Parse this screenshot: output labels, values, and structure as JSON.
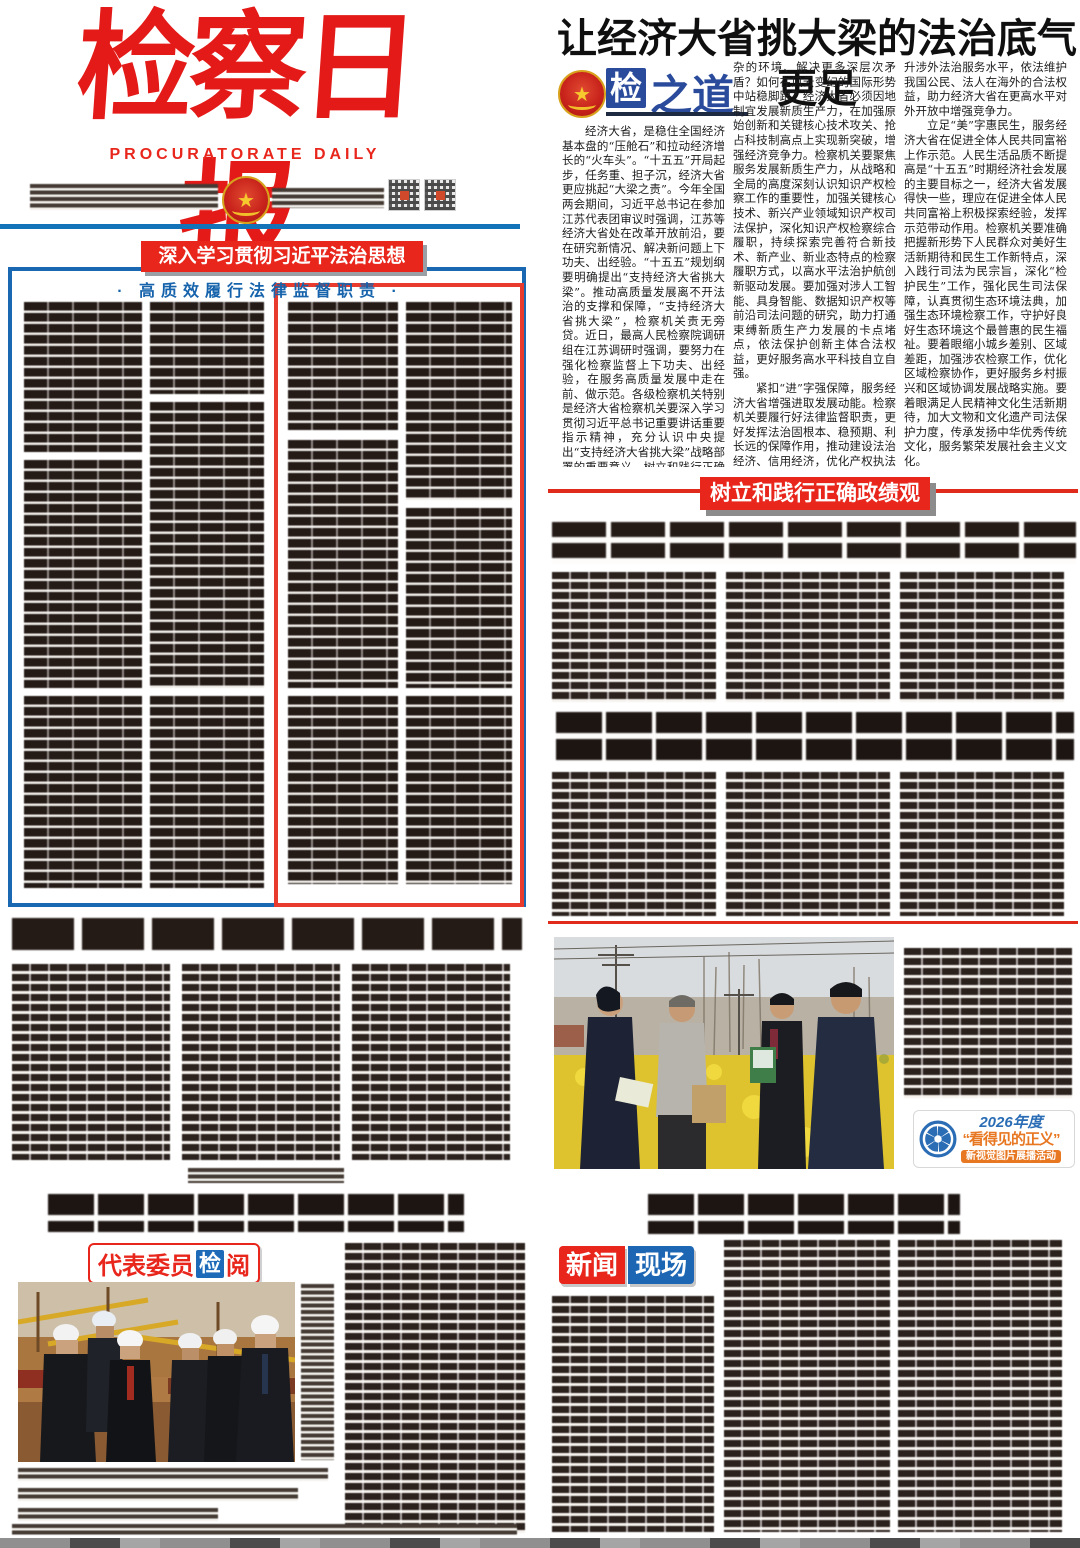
{
  "masthead": {
    "title": "检察日报",
    "subtitle": "PROCURATORATE DAILY"
  },
  "left_section": {
    "banner_line1": "深入学习贯彻习近平法治思想",
    "banner_line2": "· 高质效履行法律监督职责 ·",
    "rep_badge": {
      "part1": "代表委员",
      "part2": "检",
      "part3": "阅"
    }
  },
  "right_section": {
    "headline": "让经济大省挑大梁的法治底气更足",
    "column_badge": {
      "jian": "检",
      "zhidao": "之道"
    },
    "columns": [
      {
        "paras": [
          "经济大省，是稳住全国经济基本盘的“压舱石”和拉动经济增长的“火车头”。“十五五”开局起步，任务重、担子沉，经济大省更应挑起“大梁之责”。今年全国两会期间，习近平总书记在参加江苏代表团审议时强调，江苏等经济大省处在改革开放前沿，要在研究新情况、解决新问题上下功夫、出经验。“十五五”规划纲要明确提出“支持经济大省挑大梁”。推动高质量发展离不开法治的支撑和保障，“支持经济大省挑大梁”，检察机关责无旁贷。近日，最高人民检察院调研组在江苏调研时强调，要努力在强化检察监督上下功夫、出经验，在服务高质量发展中走在前、做示范。各级检察机关特别是经济大省检察机关要深入学习贯彻习近平总书记重要讲话重要指示精神，充分认识中央提出“支持经济大省挑大梁”战略部署的重要意义，树立和践行正确政绩观，坚持围绕中心、服务大局，锚定“稳”字强保障，紧扣“进”字护发展，立足“美”字惠民生，自觉扛起服务高质量发展的政治责任、检察责任，为经济大省挑大梁，谋新局注入更多的法治底气。"
        ]
      },
      {
        "paras": [
          "杂的环境、解决更多深层次矛盾？如何在风云变幻的国际形势中站稳脚跟？经济大省必须因地制宜发展新质生产力，在加强原始创新和关键核心技术攻关、抢占科技制高点上实现新突破，增强经济竞争力。检察机关要聚焦服务发展新质生产力，从战略和全局的高度深刻认识知识产权检察工作的重要性，加强关键核心技术、新兴产业领域知识产权司法保护，深化知识产权检察综合履职，持续探索完善符合新技术、新产业、新业态特点的检察履职方式，以高水平法治护航创新驱动发展。要加强对涉人工智能、具身智能、数据知识产权等前沿司法问题的研究，助力打通束缚新质生产力发展的卡点堵点，依法保护创新主体合法权益，更好服务高水平科技自立自强。",
          "紧扣“进”字强保障，服务经济大省增强进取发展动能。检察机关要履行好法律监督职责，更好发挥法治固根本、稳预期、利长远的保障作用，推动建设法治经济、信用经济，优化产权执法司法保护，协同做好规范涉企执法专项行动，促进打造市场化法治化国际化一流营商环境，为经济大省行稳致远筑牢坚实法治屏障。要全面加强涉外检察工作，提"
        ]
      },
      {
        "paras": [
          "升涉外法治服务水平，依法维护我国公民、法人在海外的合法权益，助力经济大省在更高水平对外开放中增强竞争力。",
          "立足“美”字惠民生，服务经济大省在促进全体人民共同富裕上作示范。人民生活品质不断提高是“十五五”时期经济社会发展的主要目标之一，经济大省发展得快一些，理应在促进全体人民共同富裕上积极探索经验，发挥示范带动作用。检察机关要准确把握新形势下人民群众对美好生活新期待和民生工作新特点，深入践行司法为民宗旨，深化“检护民生”工作，强化民生司法保障，认真贯彻生态环境法典，加强生态环境检察工作，守护好良好生态环境这个最普惠的民生福祉。要着眼缩小城乡差别、区域差距，加强涉农检察工作，优化区域检察协作，更好服务乡村振兴和区域协调发展战略实施。要着眼满足人民精神文化生活新期待，加大文物和文化遗产司法保护力度，传承发扬中华优秀传统文化，服务繁荣发展社会主义文化。",
          "当前，各经济大省正在按照党中央决策部署，把握发展主动，聚力新质新提质，奋力挑起大梁。作为国家法律监督机关和保障国家法律统一正确实施的司法机关，检察机关更要勇担使命、依法履职，强化法律监督，立足检察职能，优化检察监督，增强监督实效，以高质效检察履职服务保障“经济大省挑大梁”，以法治力量护航中国经济在推进高质量发展中乘风破浪、赢得未来。"
        ]
      }
    ],
    "section_banner": "树立和践行正确政绩观",
    "justice_badge": {
      "year": "2026年度",
      "title": "“看得见的正义”",
      "subtitle": "新视觉图片展播活动"
    },
    "news_badge": {
      "part1": "新闻",
      "part2": "现场"
    }
  },
  "colors": {
    "masthead_red": "#e31a17",
    "banner_red": "#e8261c",
    "rule_blue": "#1273b9",
    "box_blue": "#1a67b2",
    "box_red": "#e83a2d",
    "badge_blue": "#1d6ab8",
    "jzd_blue": "#2a4b9b",
    "justice_orange": "#e87722"
  }
}
